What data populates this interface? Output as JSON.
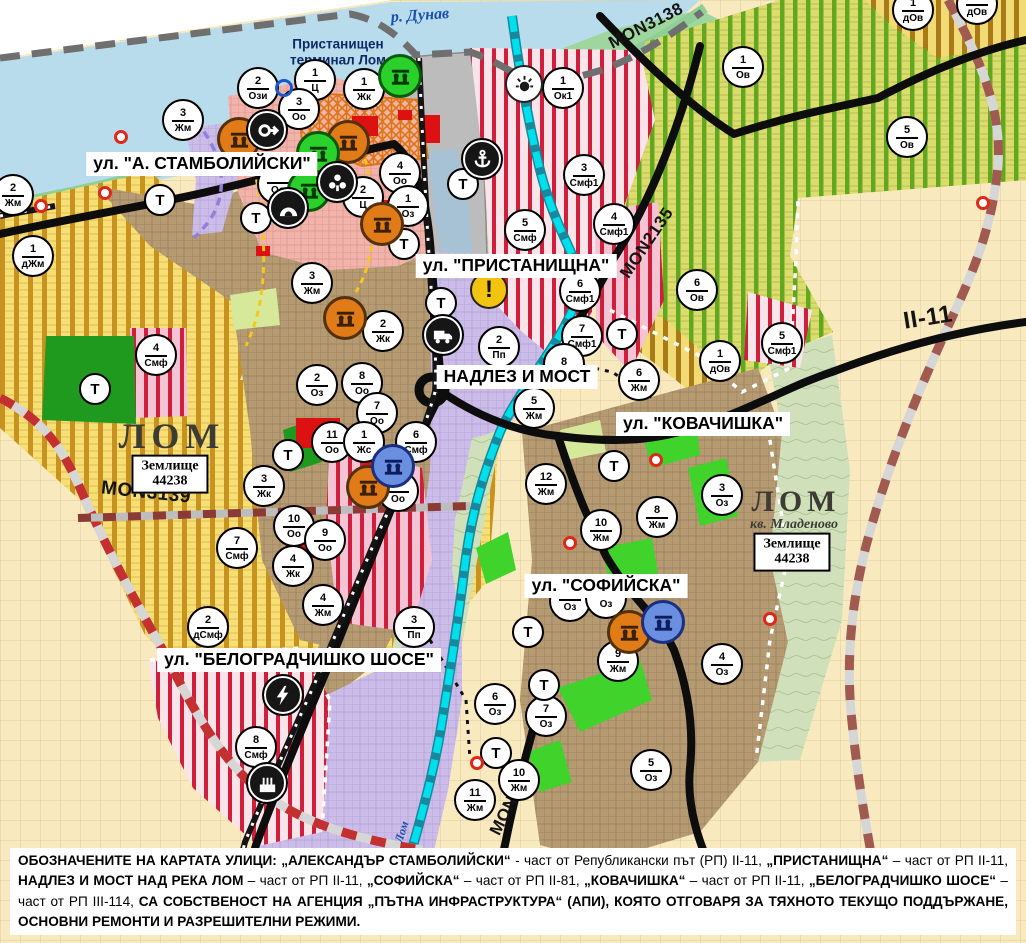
{
  "palette": {
    "water": "#b9dcec",
    "harbor": "#a7c2d4",
    "port_gray": "#bcbcbc",
    "farmland_beige": "#f8e9be",
    "yellow_zone": "#f7df76",
    "yellow_stripe": "#c8921e",
    "vineyard_bg": "#dadc6c",
    "vineyard_stripe": "#61a81e",
    "orchard_bg": "#f2db74",
    "orchard_stripe": "#a87b18",
    "town_brown": "#b69a72",
    "pink_center": "#f2b3ab",
    "purple_industry": "#ccbce9",
    "red_stripe": "#cf1f3c",
    "park_dark": "#1f9a1f",
    "park_bright": "#3fd32c",
    "shore_green": "#8fcf96",
    "river_cyan": "#00e0ec",
    "road_black": "#0d0d0d",
    "border_gray": "#6f6f6f",
    "red_dash": "#c43030",
    "marker_orange": "#e07b18",
    "marker_green": "#2bd12b",
    "marker_blue": "#6b8fe0",
    "warning_yellow": "#f2c40f",
    "red_dot": "#e02818",
    "label_blue": "#1a4fae"
  },
  "map": {
    "water_labels": [
      {
        "text": "р. Дунав",
        "x": 420,
        "y": 16,
        "rot": -4,
        "size": 16
      },
      {
        "text": "Лом",
        "x": 402,
        "y": 832,
        "rot": -72,
        "size": 12
      }
    ],
    "terminal_label": {
      "line1": "Пристанищен",
      "line2": "терминал Лом",
      "x": 338,
      "y": 52
    },
    "street_labels": [
      {
        "text": "ул. \"А. СТАМБОЛИЙСКИ\"",
        "x": 202,
        "y": 164
      },
      {
        "text": "ул. \"ПРИСТАНИЩНА\"",
        "x": 516,
        "y": 266
      },
      {
        "text": "НАДЛЕЗ И МОСТ",
        "x": 517,
        "y": 377
      },
      {
        "text": "ул. \"КОВАЧИШКА\"",
        "x": 703,
        "y": 424
      },
      {
        "text": "ул. \"СОФИЙСКА\"",
        "x": 606,
        "y": 586
      },
      {
        "text": "ул. \"БЕЛОГРАДЧИШКО ШОСЕ\"",
        "x": 299,
        "y": 660
      }
    ],
    "road_labels": [
      {
        "text": "MON3138",
        "x": 646,
        "y": 26,
        "rot": -27,
        "size": 17
      },
      {
        "text": "MON2135",
        "x": 647,
        "y": 243,
        "rot": -56,
        "size": 17
      },
      {
        "text": "II-11",
        "x": 928,
        "y": 318,
        "rot": -9,
        "size": 24
      },
      {
        "text": "MON3139",
        "x": 146,
        "y": 493,
        "rot": 6,
        "size": 19
      },
      {
        "text": "MON2136",
        "x": 513,
        "y": 798,
        "rot": -63,
        "size": 17
      }
    ],
    "area_labels": [
      {
        "text": "ЛОМ",
        "x": 172,
        "y": 436,
        "size": 36,
        "ls": 6,
        "italic": false
      },
      {
        "text": "ЛОМ",
        "x": 796,
        "y": 502,
        "size": 30,
        "ls": 5,
        "italic": false
      },
      {
        "text": "кв. Младеново",
        "x": 794,
        "y": 525,
        "size": 14,
        "ls": 0,
        "italic": true
      }
    ],
    "box_labels": [
      {
        "line1": "Землище",
        "line2": "44238",
        "x": 170,
        "y": 474
      },
      {
        "line1": "Землище",
        "line2": "44238",
        "x": 792,
        "y": 552
      }
    ],
    "zone_markers": [
      [
        "2",
        "Ози",
        258,
        88
      ],
      [
        "1",
        "Ц",
        315,
        80
      ],
      [
        "1",
        "Жк",
        364,
        89
      ],
      [
        "3",
        "Жм",
        183,
        120
      ],
      [
        "3",
        "Оо",
        299,
        109
      ],
      [
        "",
        "Оо",
        278,
        184
      ],
      [
        "4",
        "Оо",
        400,
        173
      ],
      [
        "2",
        "Ц",
        363,
        197
      ],
      [
        "1",
        "Оз",
        408,
        206
      ],
      [
        "2",
        "Жм",
        13,
        195
      ],
      [
        "1",
        "дЖм",
        33,
        256
      ],
      [
        "4",
        "Смф",
        156,
        355
      ],
      [
        "1",
        "Ок1",
        563,
        88
      ],
      [
        "3",
        "Смф1",
        584,
        175
      ],
      [
        "5",
        "Смф",
        525,
        230
      ],
      [
        "4",
        "Смф1",
        614,
        224
      ],
      [
        "6",
        "Смф1",
        580,
        291
      ],
      [
        "7",
        "Смф1",
        582,
        336
      ],
      [
        "2",
        "Пп",
        499,
        347
      ],
      [
        "8",
        "",
        564,
        364
      ],
      [
        "5",
        "Жм",
        534,
        408
      ],
      [
        "6",
        "Жм",
        639,
        380
      ],
      [
        "6",
        "Ов",
        697,
        290
      ],
      [
        "5",
        "Смф1",
        782,
        343
      ],
      [
        "1",
        "дОв",
        720,
        361
      ],
      [
        "1",
        "Ов",
        743,
        67
      ],
      [
        "5",
        "Ов",
        907,
        137
      ],
      [
        "1",
        "дОв",
        913,
        10
      ],
      [
        "1",
        "дОв",
        977,
        4
      ],
      [
        "2",
        "Оз",
        317,
        385
      ],
      [
        "8",
        "Оо",
        362,
        383
      ],
      [
        "7",
        "Оо",
        377,
        413
      ],
      [
        "11",
        "Оо",
        332,
        442
      ],
      [
        "1",
        "Жс",
        364,
        442
      ],
      [
        "6",
        "Смф",
        416,
        442
      ],
      [
        "8",
        "Оо",
        398,
        491
      ],
      [
        "3",
        "Жм",
        312,
        283
      ],
      [
        "2",
        "Жк",
        383,
        331
      ],
      [
        "3",
        "Жк",
        264,
        486
      ],
      [
        "10",
        "Оо",
        294,
        526
      ],
      [
        "9",
        "Оо",
        325,
        540
      ],
      [
        "4",
        "Жк",
        293,
        566
      ],
      [
        "7",
        "Смф",
        237,
        548
      ],
      [
        "4",
        "Жм",
        323,
        605
      ],
      [
        "2",
        "дСмф",
        208,
        627
      ],
      [
        "3",
        "Пп",
        414,
        627
      ],
      [
        "8",
        "Смф",
        256,
        747
      ],
      [
        "12",
        "Жм",
        546,
        484
      ],
      [
        "10",
        "Жм",
        601,
        530
      ],
      [
        "8",
        "Жм",
        657,
        517
      ],
      [
        "3",
        "Оз",
        722,
        495
      ],
      [
        "9",
        "Жм",
        618,
        661
      ],
      [
        "4",
        "Оз",
        722,
        664
      ],
      [
        "6",
        "Оз",
        495,
        704
      ],
      [
        "7",
        "Оз",
        546,
        716
      ],
      [
        "5",
        "Оз",
        651,
        770
      ],
      [
        "10",
        "Жм",
        519,
        780
      ],
      [
        "11",
        "Жм",
        475,
        800
      ],
      [
        "",
        "Оз",
        570,
        601
      ],
      [
        "",
        "Оз",
        606,
        598
      ]
    ],
    "t_markers": [
      [
        160,
        200
      ],
      [
        256,
        218
      ],
      [
        95,
        389
      ],
      [
        463,
        184
      ],
      [
        404,
        244
      ],
      [
        441,
        303
      ],
      [
        622,
        334
      ],
      [
        614,
        466
      ],
      [
        528,
        632
      ],
      [
        544,
        685
      ],
      [
        496,
        753
      ],
      [
        288,
        455
      ]
    ],
    "t_label": "Т",
    "icon_markers": [
      {
        "x": 239,
        "y": 139,
        "type": "culture-monument-icon",
        "bg": "orange"
      },
      {
        "x": 348,
        "y": 142,
        "type": "culture-monument-icon",
        "bg": "orange"
      },
      {
        "x": 382,
        "y": 224,
        "type": "culture-monument-icon",
        "bg": "orange"
      },
      {
        "x": 345,
        "y": 318,
        "type": "culture-monument-icon",
        "bg": "orange"
      },
      {
        "x": 368,
        "y": 487,
        "type": "culture-monument-icon",
        "bg": "orange"
      },
      {
        "x": 629,
        "y": 632,
        "type": "culture-monument-icon",
        "bg": "orange"
      },
      {
        "x": 400,
        "y": 76,
        "type": "culture-monument-icon",
        "bg": "green"
      },
      {
        "x": 318,
        "y": 153,
        "type": "culture-monument-icon",
        "bg": "green"
      },
      {
        "x": 309,
        "y": 190,
        "type": "culture-monument-icon",
        "bg": "green"
      },
      {
        "x": 393,
        "y": 466,
        "type": "culture-monument-icon",
        "bg": "blue"
      },
      {
        "x": 663,
        "y": 622,
        "type": "culture-monument-icon",
        "bg": "blue"
      },
      {
        "x": 267,
        "y": 130,
        "type": "key-icon",
        "bg": "black"
      },
      {
        "x": 337,
        "y": 182,
        "type": "people-icon",
        "bg": "black"
      },
      {
        "x": 288,
        "y": 208,
        "type": "cave-icon",
        "bg": "black"
      },
      {
        "x": 482,
        "y": 159,
        "type": "anchor-icon",
        "bg": "black"
      },
      {
        "x": 443,
        "y": 335,
        "type": "truck-icon",
        "bg": "black"
      },
      {
        "x": 283,
        "y": 695,
        "type": "power-icon",
        "bg": "black"
      },
      {
        "x": 267,
        "y": 783,
        "type": "factory-icon",
        "bg": "black"
      },
      {
        "x": 524,
        "y": 84,
        "type": "sun-icon",
        "bg": "white"
      },
      {
        "x": 489,
        "y": 290,
        "type": "warning-icon",
        "bg": "yellow"
      },
      {
        "x": 284,
        "y": 88,
        "type": "point-icon",
        "bg": "ring"
      }
    ],
    "red_dots": [
      [
        121,
        137
      ],
      [
        41,
        206
      ],
      [
        105,
        193
      ],
      [
        656,
        460
      ],
      [
        770,
        619
      ],
      [
        570,
        543
      ],
      [
        477,
        763
      ],
      [
        983,
        203
      ]
    ]
  },
  "note": {
    "segments": [
      {
        "b": 1,
        "t": "ОБОЗНАЧЕНИТЕ НА КАРТАТА УЛИЦИ: „АЛЕКСАНДЪР СТАМБОЛИЙСКИ“"
      },
      {
        "b": 0,
        "t": " - част от Републикански път (РП) II-11, "
      },
      {
        "b": 1,
        "t": "„ПРИСТАНИЩНА“"
      },
      {
        "b": 0,
        "t": " – част от РП II-11, "
      },
      {
        "b": 1,
        "t": "НАДЛЕЗ И МОСТ НАД РЕКА ЛОМ"
      },
      {
        "b": 0,
        "t": " – част от РП II-11, "
      },
      {
        "b": 1,
        "t": "„СОФИЙСКА“"
      },
      {
        "b": 0,
        "t": " – част от РП II-81, "
      },
      {
        "b": 1,
        "t": "„КОВАЧИШКА“"
      },
      {
        "b": 0,
        "t": " – част от РП II-11, "
      },
      {
        "b": 1,
        "t": "„БЕЛОГРАДЧИШКО ШОСЕ“"
      },
      {
        "b": 0,
        "t": " – част от РП III-114, "
      },
      {
        "b": 1,
        "t": "СА СОБСТВЕНОСТ НА АГЕНЦИЯ „ПЪТНА ИНФРАСТРУКТУРА“ (АПИ), КОЯТО ОТГОВАРЯ ЗА ТЯХНОТО ТЕКУЩО ПОДДЪРЖАНЕ, ОСНОВНИ РЕМОНТИ И РАЗРЕШИТЕЛНИ РЕЖИМИ."
      }
    ]
  }
}
